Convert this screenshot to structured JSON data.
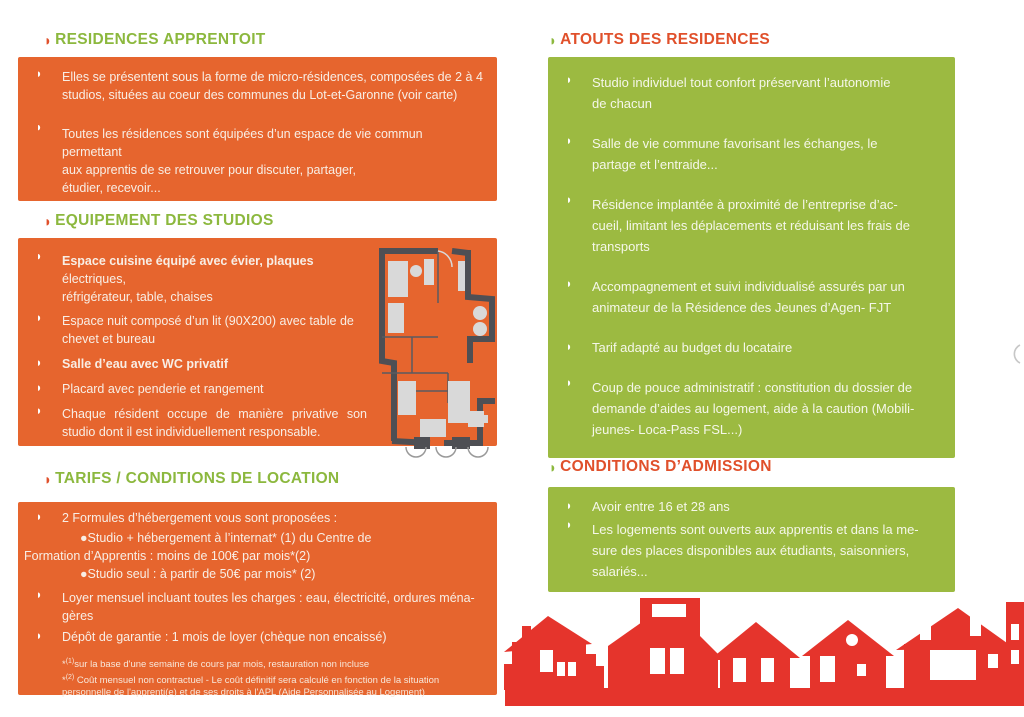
{
  "colors": {
    "box_orange": "#E6652E",
    "box_green": "#9CBA41",
    "heading_green": "#8CB83E",
    "heading_orange": "#E0502B",
    "houses_red": "#E5342C",
    "plan_wall_gray": "#4E4F54",
    "body_text_on_orange": "#F8EEE5",
    "body_text_on_green": "#F5F7E9"
  },
  "glyphs": {
    "bullet": "◗"
  },
  "left": {
    "residences": {
      "heading": "RESIDENCES APPRENTOIT",
      "bullets": [
        "Elles se présentent sous la forme de micro-résidences, composées de 2 à 4 studios, situées au coeur des communes du Lot-et-Garonne (voir carte)",
        "Toutes les résidences sont équipées d’un espace de vie commun  permettant\naux apprentis de se retrouver pour discuter, partager,\nétudier, recevoir..."
      ]
    },
    "equipement": {
      "heading": "EQUIPEMENT DES STUDIOS",
      "bullets": [
        {
          "bold": "Espace cuisine équipé avec évier, plaques ",
          "text": "électriques,\nréfrigérateur, table, chaises"
        },
        {
          "bold": "",
          "text": "Espace nuit composé d’un lit (90X200) avec table de\nchevet et bureau"
        },
        {
          "bold": "Salle d’eau avec WC privatif",
          "text": ""
        },
        {
          "bold": "",
          "text": "Placard avec penderie et rangement"
        },
        {
          "bold": "",
          "text": "Chaque résident occupe de manière privative son studio dont il est individuellement responsable."
        }
      ],
      "floor_plan_alt": "studio-floor-plan"
    },
    "tarifs": {
      "heading": "TARIFS / CONDITIONS DE LOCATION",
      "intro": "2 Formules d’hébergement vous sont proposées :",
      "option1_line1": "●Studio + hébergement à l’internat* (1) du Centre de",
      "option1_line2": "Formation d’Apprentis : moins de 100€ par mois*(2)",
      "option2": "●Studio seul : à partir de 50€ par mois* (2)",
      "bullets": [
        "Loyer mensuel incluant toutes les charges : eau, électricité, ordures ména-\ngères",
        "Dépôt de garantie : 1 mois de loyer (chèque non encaissé)"
      ],
      "footnotes": [
        {
          "star": "*",
          "sup": "(1)",
          "text": "sur la base d'une semaine de cours par mois,  restauration non incluse"
        },
        {
          "star": "*",
          "sup": "(2)",
          "text": " Coût mensuel non contractuel - Le coût définitif sera calculé en fonction de la situation personnelle de l'apprenti(e) et de ses droits à l'APL (Aide Personnalisée au Logement)"
        }
      ]
    }
  },
  "right": {
    "atouts": {
      "heading": "ATOUTS DES RESIDENCES",
      "bullets": [
        "Studio individuel tout confort préservant l’autonomie\nde chacun",
        "Salle de vie commune favorisant les échanges, le\npartage et l’entraide...",
        "Résidence implantée à proximité de l’entreprise d’ac-\ncueil, limitant les déplacements et réduisant les frais de\ntransports",
        "Accompagnement et suivi individualisé assurés par un\nanimateur de la Résidence des Jeunes d’Agen- FJT",
        "Tarif adapté au budget du locataire",
        "Coup de pouce administratif : constitution du dossier de\ndemande d’aides au logement, aide à la caution (Mobili-\njeunes-  Loca-Pass FSL...)"
      ]
    },
    "conditions": {
      "heading": "CONDITIONS D’ADMISSION",
      "bullets": [
        "Avoir entre 16 et 28 ans",
        "Les logements sont ouverts aux apprentis et dans la me-\nsure des places disponibles aux étudiants, saisonniers,\nsalariés..."
      ]
    },
    "village_alt": "red-houses-silhouette"
  }
}
